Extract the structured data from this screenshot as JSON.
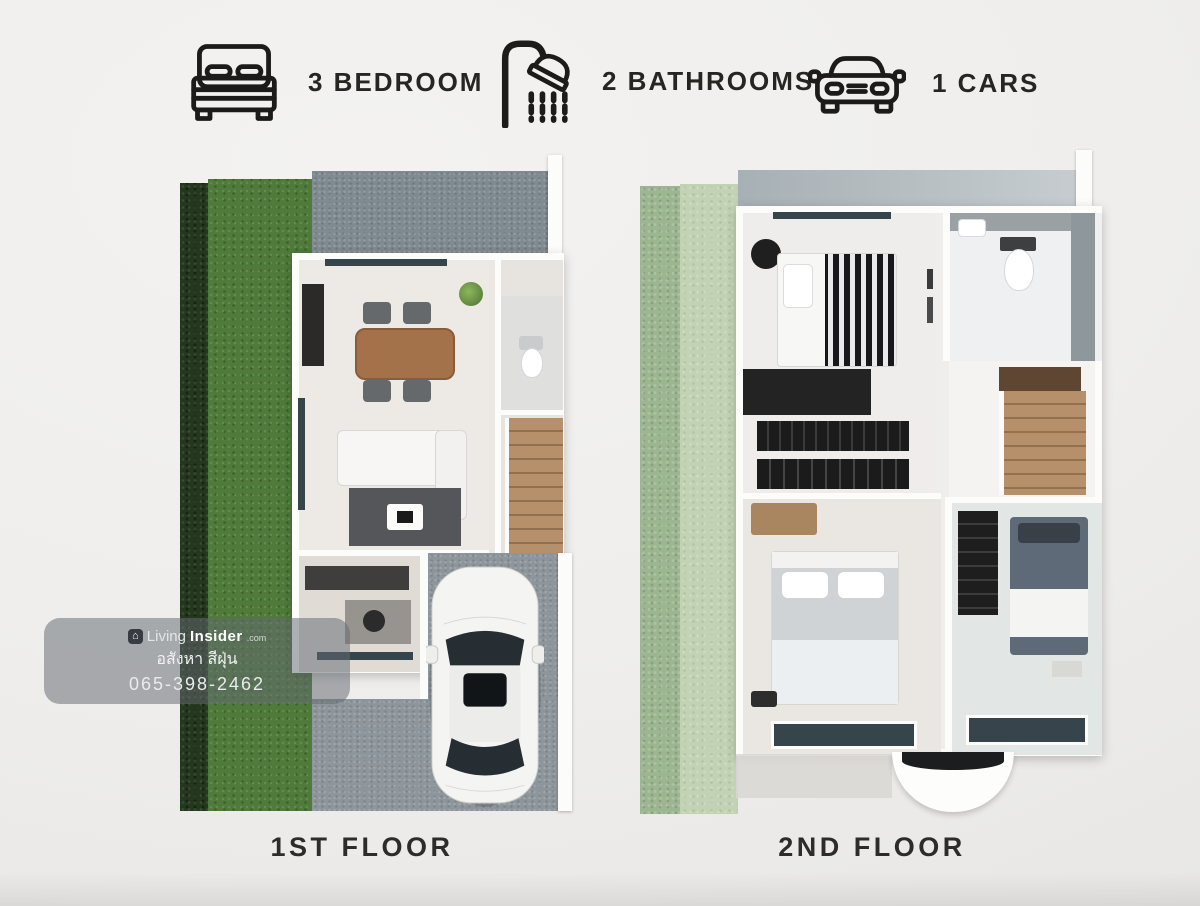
{
  "header": {
    "features": [
      {
        "icon": "bed-icon",
        "label": "3 BEDROOM"
      },
      {
        "icon": "shower-icon",
        "label": "2 BATHROOMS"
      },
      {
        "icon": "car-icon",
        "label": "1 CARS"
      }
    ]
  },
  "floors": [
    {
      "label": "1ST FLOOR"
    },
    {
      "label": "2ND FLOOR"
    }
  ],
  "watermark": {
    "brand_prefix": "Living",
    "brand_suffix": "Insider",
    "brand_tld": ".com",
    "subtitle": "อสังหา สีฝุ่น",
    "phone": "065-398-2462"
  },
  "colors": {
    "background": "#efeeec",
    "text": "#2a2927",
    "hedge_green": "#24381d",
    "lawn_green": "#4f7a3a",
    "faded_garden_green": "#c2d3b3",
    "concrete_gray": "#7f8a91",
    "wall_white": "#fcfcfb",
    "wood_brown": "#b5906a",
    "window_glass": "#36444c",
    "watermark_bg": "rgba(99,105,114,0.52)"
  }
}
